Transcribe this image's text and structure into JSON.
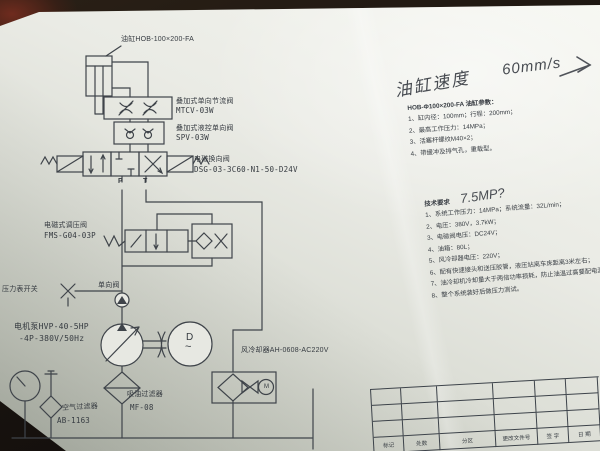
{
  "diagram": {
    "cylinder_label": "油缸HOB-100×200-FA",
    "throttle_valve_name": "叠加式单向节流阀",
    "throttle_valve_model": "MTCV-03W",
    "pilot_check_name": "叠加式液控单向阀",
    "pilot_check_model": "SPV-03W",
    "directional_valve_name": "电磁换向阀",
    "directional_valve_model": "DSG-03-3C60-N1-50-D24V",
    "relief_valve_name": "电磁式调压阀",
    "relief_valve_model": "FMS-G04-03P",
    "pressure_gauge_switch": "压力表开关",
    "check_valve": "单向阀",
    "pump_label_line1": "电机泵HVP-40-5HP",
    "pump_label_line2": "-4P-380V/50Hz",
    "cooler_label": "风冷却器AH-0608-AC220V",
    "air_filter_name": "空气过滤器",
    "air_filter_model": "AB-1163",
    "suction_filter_name": "吸油过滤器",
    "suction_filter_model": "MF-08",
    "port_p": "P",
    "port_t": "T",
    "motor_letter": "D",
    "motor_wave": "~",
    "fan_motor_letter": "M"
  },
  "handwriting": {
    "speed_label": "油缸速度",
    "speed_value": "60mm/s",
    "pressure_note": "7.5MP?"
  },
  "cylinder_params": {
    "title": "HOB-Φ100×200-FA 油缸参数：",
    "items": [
      "1、缸内径：100mm；行程：200mm；",
      "2、最高工作压力：14MPa；",
      "3、活塞杆螺纹M40×2；",
      "4、带缓冲及排气孔，重载型。"
    ]
  },
  "tech_requirements": {
    "title": "技术要求",
    "items": [
      "1、系统工作压力：14MPa；系统流量：32L/min；",
      "2、电压：380V，3.7kW；",
      "3、电磁阀电压：DC24V；",
      "4、油箱：80L；",
      "5、风冷却器电压：220V；",
      "6、配有快速接头和送压胶管，液压站离车床距离3米左右；",
      "7、油冷却机冷却量大于两倍功率损耗，防止油温过高要配电源；",
      "8、整个系统装好后做压力测试。"
    ]
  },
  "title_block": {
    "cells": [
      "标记",
      "处数",
      "分区",
      "更改文件号",
      "签 字",
      "日 期"
    ]
  }
}
